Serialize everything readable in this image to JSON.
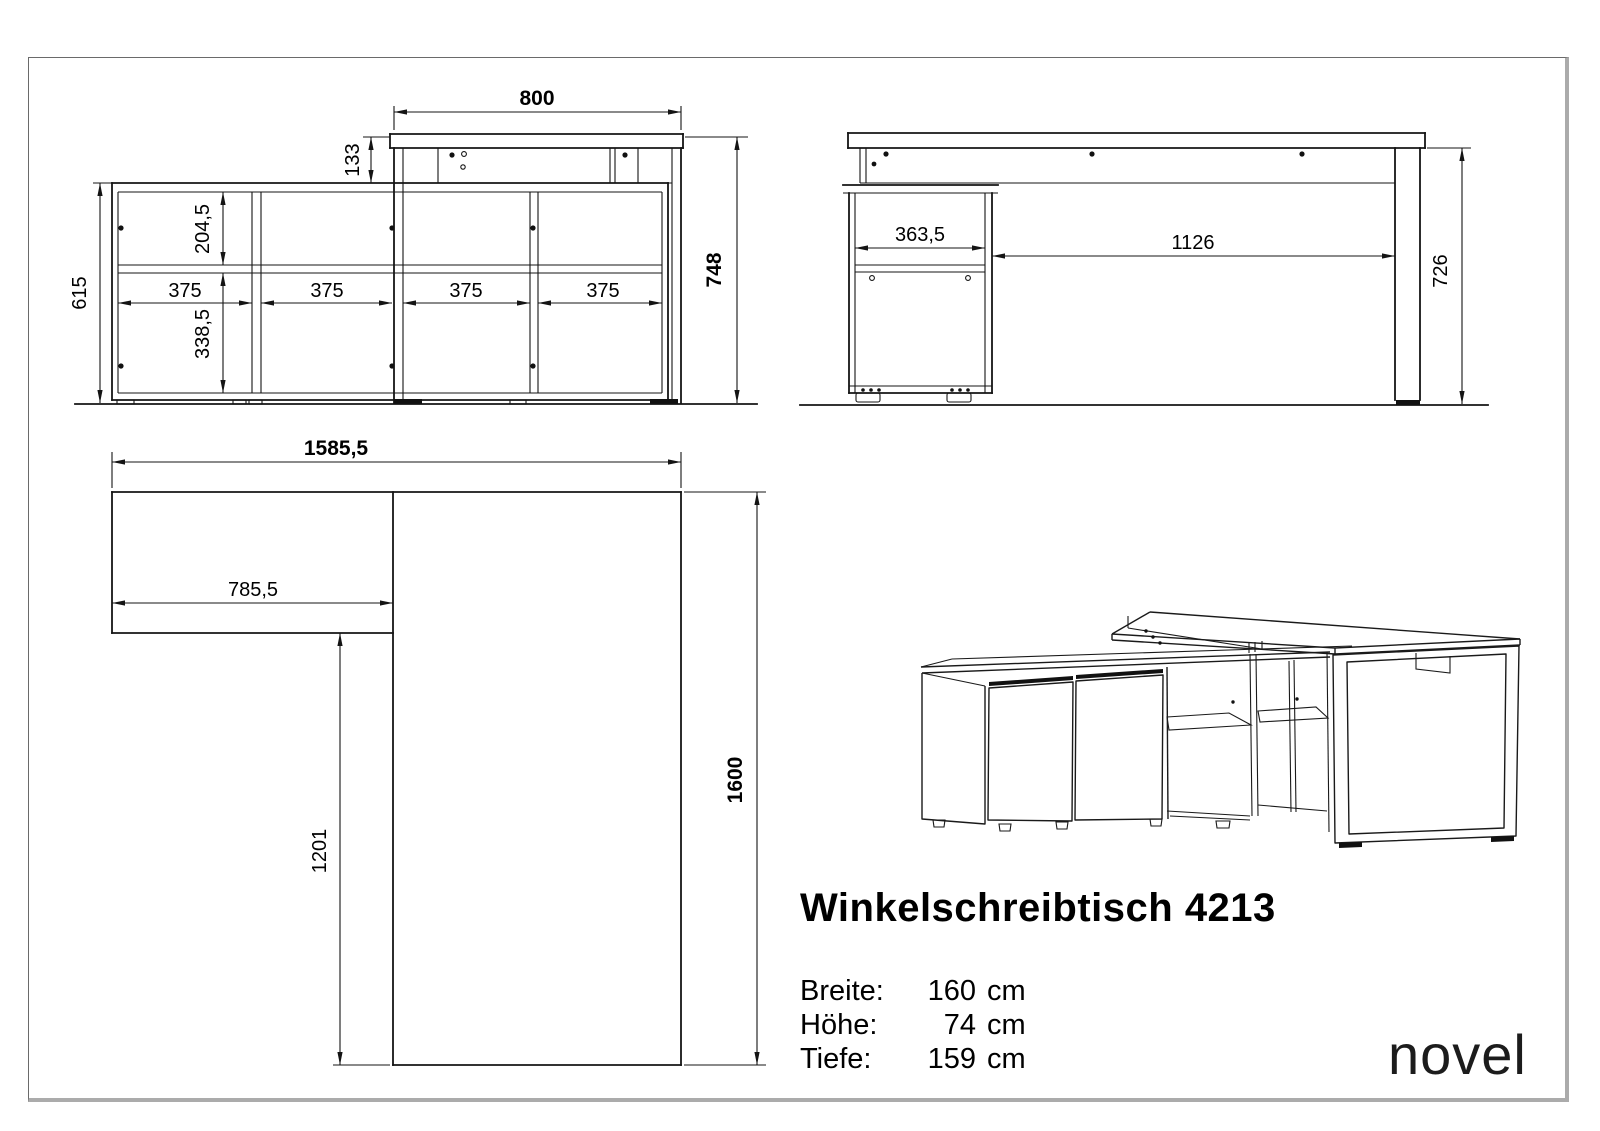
{
  "page": {
    "background": "#ffffff",
    "border_color": "#6a6a6a",
    "shadow_color": "#ababab",
    "line_color": "#141414"
  },
  "front_view": {
    "name": "front elevation",
    "dims": {
      "width": "800",
      "top_offset": "133",
      "upper_inner": "204,5",
      "side_height": "615",
      "compartments": [
        "375",
        "375",
        "375",
        "375"
      ],
      "lower_inner": "338,5",
      "total_height": "748"
    }
  },
  "side_view": {
    "name": "side elevation",
    "dims": {
      "cabinet_depth": "363,5",
      "clear_span": "1126",
      "leg_height": "726"
    }
  },
  "plan_view": {
    "name": "top plan",
    "dims": {
      "total_width": "1585,5",
      "return_width": "785,5",
      "return_clear_depth": "1201",
      "total_depth": "1600"
    }
  },
  "title_block": {
    "title": "Winkelschreibtisch 4213",
    "specs": [
      {
        "label": "Breite:",
        "value": "160",
        "unit": "cm"
      },
      {
        "label": "Höhe:",
        "value": "74",
        "unit": "cm"
      },
      {
        "label": "Tiefe:",
        "value": "159",
        "unit": "cm"
      }
    ]
  },
  "brand": {
    "logo": "novel"
  }
}
